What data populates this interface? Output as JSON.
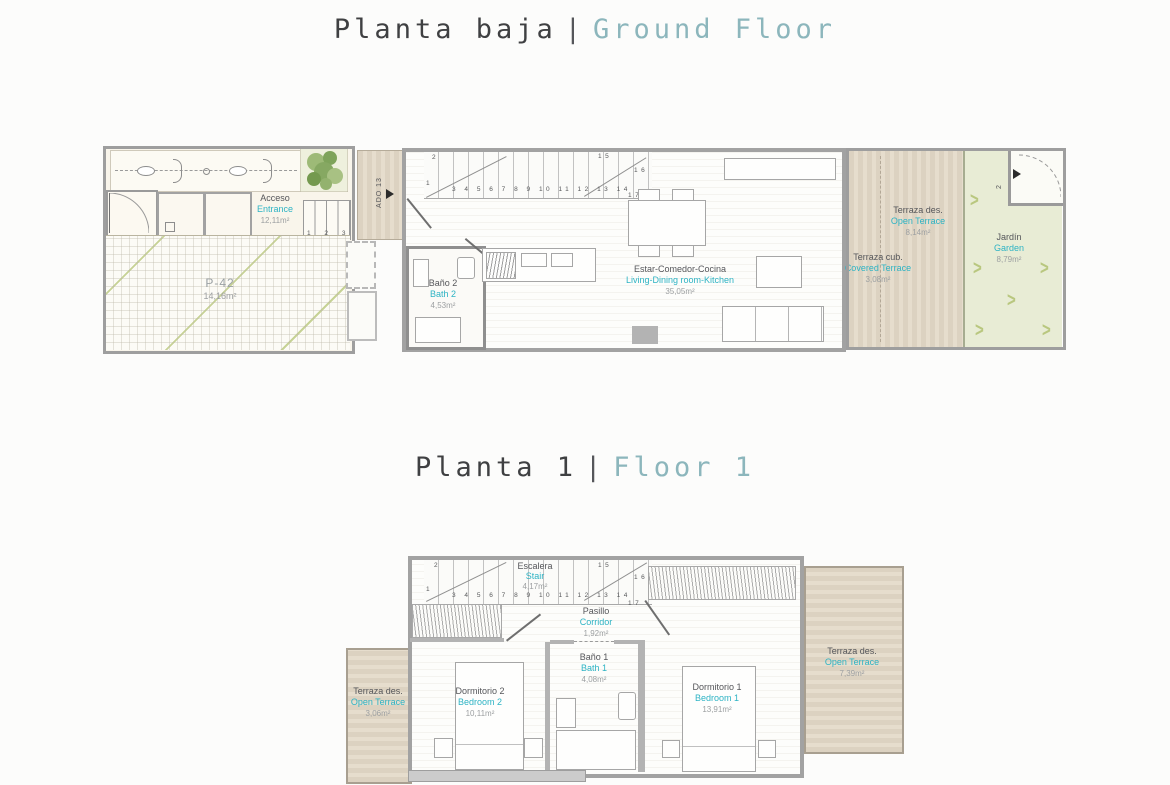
{
  "titles": {
    "ground": {
      "es": "Planta baja",
      "sep": "|",
      "en": "Ground Floor"
    },
    "floor1": {
      "es": "Planta 1",
      "sep": "|",
      "en": "Floor 1"
    }
  },
  "colors": {
    "title_dark": "#3f4042",
    "title_teal": "#8cb6bc",
    "label_teal": "#2db3c4",
    "label_dark": "#55565a",
    "area_gray": "#9da0a2",
    "terrace_tan": "#dcd2c1",
    "garden_green": "#e8ecd5",
    "wall_gray": "#a2a2a2"
  },
  "ground_floor": {
    "parking": {
      "name_es": "P-42",
      "area": "14,16m²"
    },
    "entrance": {
      "name_es": "Acceso",
      "name_en": "Entrance",
      "area": "12,11m²",
      "steps": "1 2 3 4"
    },
    "ado_label": "ADO 13",
    "stair": {
      "n1": "1",
      "n2": "2",
      "row": "3 4 5 6 7 8 9 10 11 12 13 14",
      "n15": "15",
      "n16": "16",
      "n17": "17"
    },
    "bath2": {
      "name_es": "Baño 2",
      "name_en": "Bath 2",
      "area": "4,53m²"
    },
    "living": {
      "name_es": "Estar-Comedor-Cocina",
      "name_en": "Living-Dining room-Kitchen",
      "area": "35,05m²"
    },
    "open_terrace": {
      "name_es": "Terraza des.",
      "name_en": "Open Terrace",
      "area": "8,14m²"
    },
    "covered_terrace": {
      "name_es": "Terraza cub.",
      "name_en": "Covered Terrace",
      "area": "3,08m²"
    },
    "garden": {
      "name_es": "Jardín",
      "name_en": "Garden",
      "area": "8,79m²",
      "gate_step": "2"
    }
  },
  "floor_1": {
    "stair": {
      "name_es": "Escalera",
      "name_en": "Stair",
      "area": "4,17m²",
      "n1": "1",
      "n2": "2",
      "row": "3 4 5 6 7 8 9 10 11 12 13 14",
      "n15": "15",
      "n16": "16",
      "n17": "17"
    },
    "corridor": {
      "name_es": "Pasillo",
      "name_en": "Corridor",
      "area": "1,92m²"
    },
    "terrace_left": {
      "name_es": "Terraza des.",
      "name_en": "Open Terrace",
      "area": "3,06m²"
    },
    "bedroom2": {
      "name_es": "Dormitorio 2",
      "name_en": "Bedroom 2",
      "area": "10,11m²"
    },
    "bath1": {
      "name_es": "Baño 1",
      "name_en": "Bath 1",
      "area": "4,08m²"
    },
    "bedroom1": {
      "name_es": "Dormitorio 1",
      "name_en": "Bedroom 1",
      "area": "13,91m²"
    },
    "terrace_right": {
      "name_es": "Terraza des.",
      "name_en": "Open Terrace",
      "area": "7,39m²"
    }
  }
}
